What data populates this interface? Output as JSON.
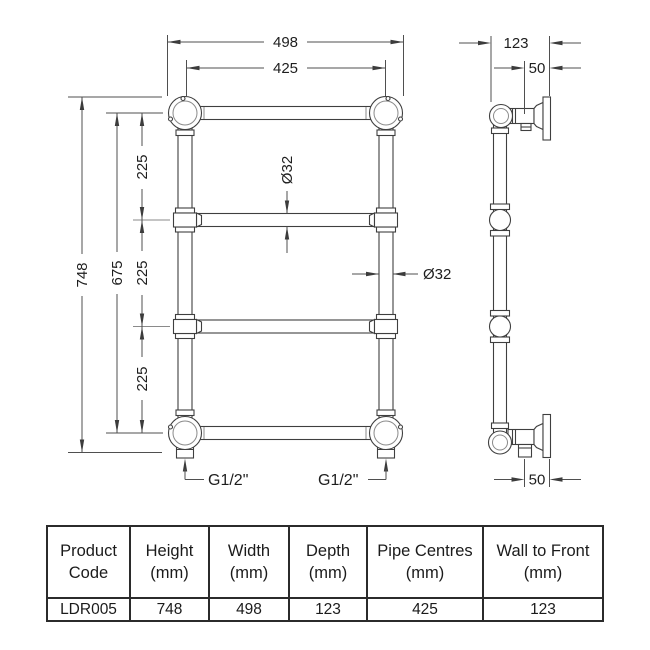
{
  "drawing": {
    "front": {
      "width_outer": "498",
      "pipe_centres": "425",
      "height_overall": "748",
      "rail_centres": "675",
      "rail_gaps": [
        "225",
        "225",
        "225"
      ],
      "rail_diameter": "Ø32",
      "pipe_diameter": "Ø32",
      "connection_left": "G1/2\"",
      "connection_right": "G1/2\""
    },
    "side": {
      "depth": "123",
      "wall_to_pipe_top": "50",
      "wall_to_pipe_bottom": "50"
    }
  },
  "table": {
    "headers": [
      {
        "l1": "Product",
        "l2": "Code"
      },
      {
        "l1": "Height",
        "l2": "(mm)"
      },
      {
        "l1": "Width",
        "l2": "(mm)"
      },
      {
        "l1": "Depth",
        "l2": "(mm)"
      },
      {
        "l1": "Pipe Centres",
        "l2": "(mm)"
      },
      {
        "l1": "Wall to Front",
        "l2": "(mm)"
      }
    ],
    "row": [
      "LDR005",
      "748",
      "498",
      "123",
      "425",
      "123"
    ]
  },
  "colors": {
    "line": "#3f3f3f",
    "dimension_line": "#4f4f4f",
    "text": "#1e1e1e",
    "table_border": "#2b2b2b",
    "background": "#ffffff"
  }
}
